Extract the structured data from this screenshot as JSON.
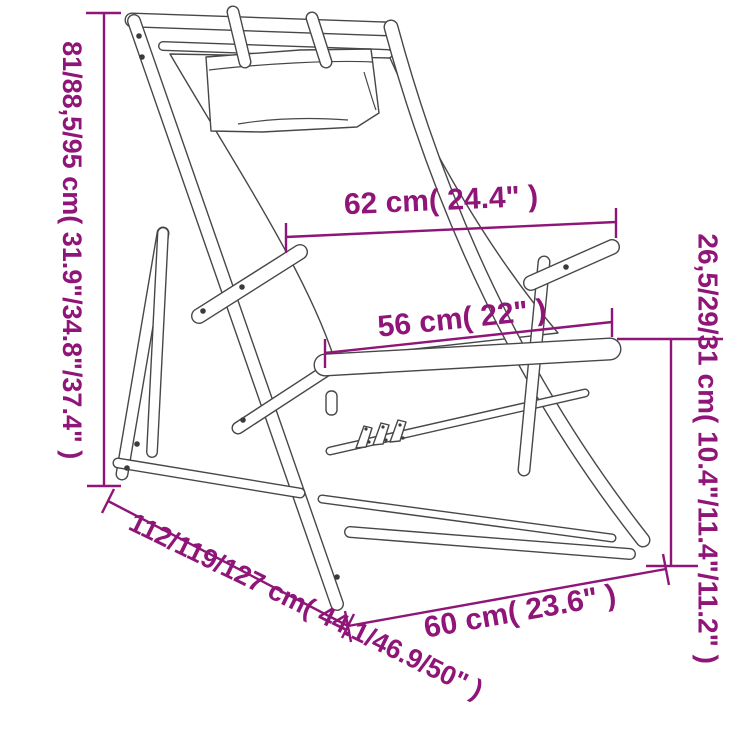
{
  "illustration": {
    "alt": "Line drawing of a folding wooden deck chair with fabric sling and head pillow, annotated with dimensions"
  },
  "dimension_labels": {
    "left_height": "81/88,5/95 cm( 31.9\"/34.8\"/37.4\" )",
    "top_width": "62 cm( 24.4\" )",
    "middle_width": "56 cm( 22\" )",
    "right_seat_height": "26,5/29/31 cm( 10.4\"/11.4\"/11.2\" )",
    "diagonal_depth": "112/119/127 cm( 44.1/46.9/50\" )",
    "bottom_width": "60 cm( 23.6\" )"
  },
  "colors": {
    "dimension_annotation": "#8F1578",
    "chair_outline": "#474747",
    "background": "#FFFFFF"
  }
}
